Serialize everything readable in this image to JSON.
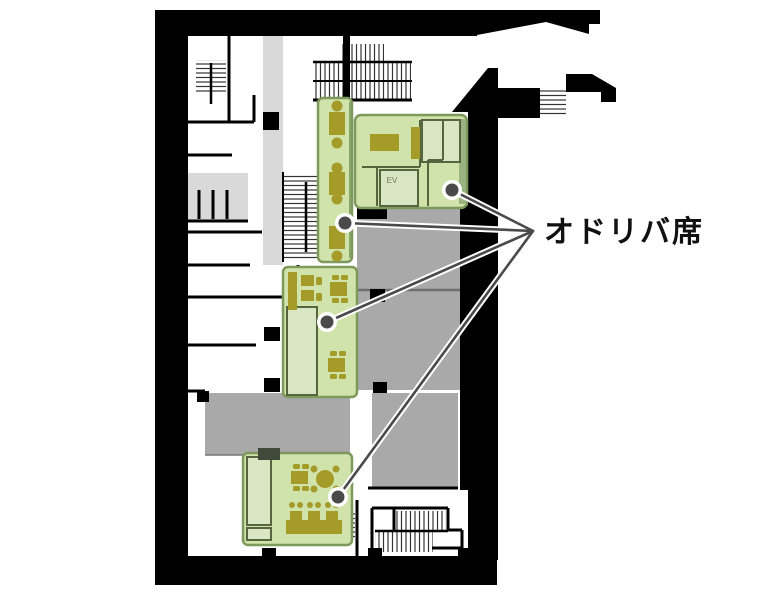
{
  "floor_plan": {
    "annotation_label": "オドリバ席",
    "elevator_label": "EV",
    "highlighted_area_count": 4,
    "colors": {
      "background": "#ffffff",
      "wall_black": "#000000",
      "room_gray": "#a9a9a9",
      "corridor_gray": "#d9d9d9",
      "highlight_green": "#cfe3ab",
      "highlight_green_light": "#d8e6c3",
      "highlight_green_border": "#7d9a5c",
      "interior_wall_green": "#55663f",
      "furniture_olive": "#a59b29",
      "callout_line": "#4a4a4a",
      "label_text": "#111111"
    }
  }
}
